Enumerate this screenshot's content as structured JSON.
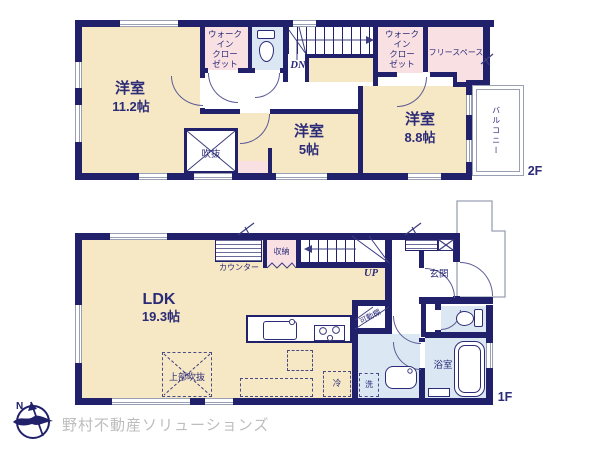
{
  "plan": {
    "floor2": {
      "tag": "2F",
      "rooms": {
        "bedroom1": {
          "name": "洋室",
          "size": "11.2帖"
        },
        "bedroom2": {
          "name": "洋室",
          "size": "5帖"
        },
        "bedroom3": {
          "name": "洋室",
          "size": "8.8帖"
        },
        "wic1_lines": [
          "ウォーク",
          "イン",
          "クロー",
          "ゼット"
        ],
        "wic2_lines": [
          "ウォーク",
          "イン",
          "クロー",
          "ゼット"
        ],
        "free_space": "フリースペース",
        "void": "吹抜",
        "balcony": "バルコニー",
        "stairs_down": "DN"
      }
    },
    "floor1": {
      "tag": "1F",
      "rooms": {
        "ldk": {
          "name": "LDK",
          "size": "19.3帖"
        },
        "counter": "カウンター",
        "storage": "収納",
        "stairs_up": "UP",
        "entrance": "玄関",
        "shelf": "可動棚",
        "washer": "洗",
        "fridge": "冷",
        "bathroom": "浴室",
        "open_above": "上部吹抜"
      }
    }
  },
  "brand": {
    "logo_text": "野村不動産ソリューションズ",
    "compass_north": "N"
  },
  "colors": {
    "wall": "#20206b",
    "room_cream": "#f7e8c5",
    "closet_pink": "#f8e0e3",
    "wet_blue": "#dbe8f4",
    "outline_gray": "#9aa0b4",
    "text_navy": "#2b2b78",
    "logo_gray": "#bdbdbd"
  }
}
